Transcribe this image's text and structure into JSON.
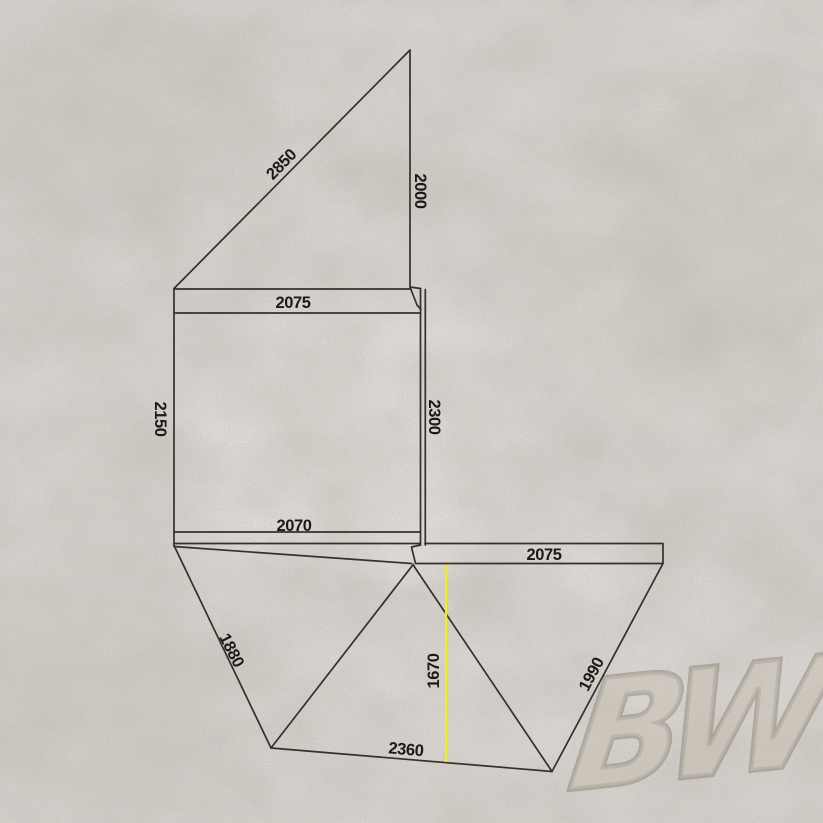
{
  "page": {
    "background_color": "#d8d5d1",
    "texture": "concrete"
  },
  "watermark": {
    "text": "BW",
    "color": "#8f8576"
  },
  "diagram": {
    "type": "awning-footprint-dimension-drawing",
    "line_color": "#34312d",
    "label_color": "#1c1a18",
    "highlight_color": "#f2ee1c",
    "labels": {
      "roof_diagonal": "2850",
      "roof_right_edge": "2000",
      "top_strip_width": "2075",
      "wall_left_height": "2150",
      "wall_right_height": "2300",
      "bottom_strip_width": "2070",
      "left_panel_edge": "1880",
      "right_strip_width": "2075",
      "center_panel_height": "1670",
      "center_panel_base": "2360",
      "right_panel_edge": "1990"
    }
  }
}
